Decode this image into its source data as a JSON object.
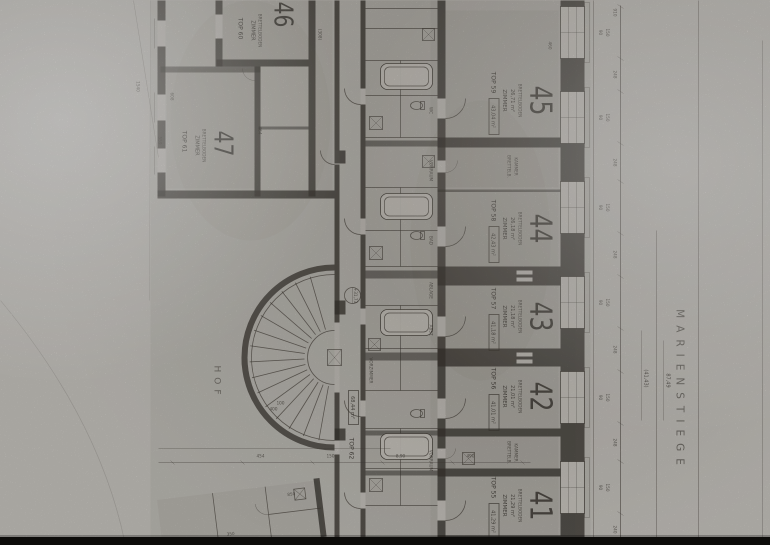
{
  "scan": {
    "street_name": "MARIENSTIEGE",
    "courtyard": "HOF",
    "level_mark": "+31,73",
    "apartments": [
      {
        "number": "45",
        "top": "TOP 59",
        "total": "43,04 m²",
        "room": "ZIMMER",
        "area": "26,71 m²",
        "floor": "BRETTELBODEN"
      },
      {
        "number": "44",
        "top": "TOP 58",
        "total": "42,43 m²",
        "room": "ZIMMER",
        "area": "26,18 m²",
        "floor": "BRETTELBODEN"
      },
      {
        "number": "43",
        "top": "TOP 57",
        "total": "41,18 m²",
        "room": "ZIMMER",
        "area": "21,18 m²",
        "floor": "BRETTELBODEN"
      },
      {
        "number": "42",
        "top": "TOP 56",
        "total": "41,01 m²",
        "room": "ZIMMER",
        "area": "21,01 m²",
        "floor": "BRETTELBODEN"
      },
      {
        "number": "41",
        "top": "TOP 55",
        "total": "41,29 m²",
        "room": "ZIMMER",
        "area": "21,29 m²",
        "floor": "BRETTELBODEN"
      },
      {
        "number": "46",
        "top": "TOP 60",
        "room": "ZIMMER",
        "floor": "BRETTELBODEN"
      },
      {
        "number": "47",
        "top": "TOP 61",
        "room": "ZIMMER",
        "floor": "BRETTELBODEN"
      }
    ],
    "corridor_unit": {
      "top": "TOP 62",
      "total": "68,44 m²"
    },
    "kammer": {
      "name": "KAMMER",
      "floor": "BRETTELB."
    },
    "rooms_small": {
      "bad": "BAD",
      "wc": "WC",
      "vorraum": "VORRAUM",
      "ablage": "ABLAGE",
      "vorzimmer": "VORZIMMER",
      "abst": "ABST."
    },
    "dims": {
      "win_w": "150",
      "win_h": "90",
      "pier": "248",
      "pier_left": "910",
      "pier_right": "240",
      "run_total": "87,49",
      "run_paren": "(41,43)",
      "fold": "1540",
      "cy1": "490",
      "cy2": "8,90",
      "cy3": "350",
      "cy4": "150",
      "cy5": "454",
      "cy6": "850",
      "r1": "460",
      "r2": "(308)",
      "r3": "608",
      "r4": "559",
      "r5": "464",
      "s1": "100",
      "s2": "400"
    }
  }
}
